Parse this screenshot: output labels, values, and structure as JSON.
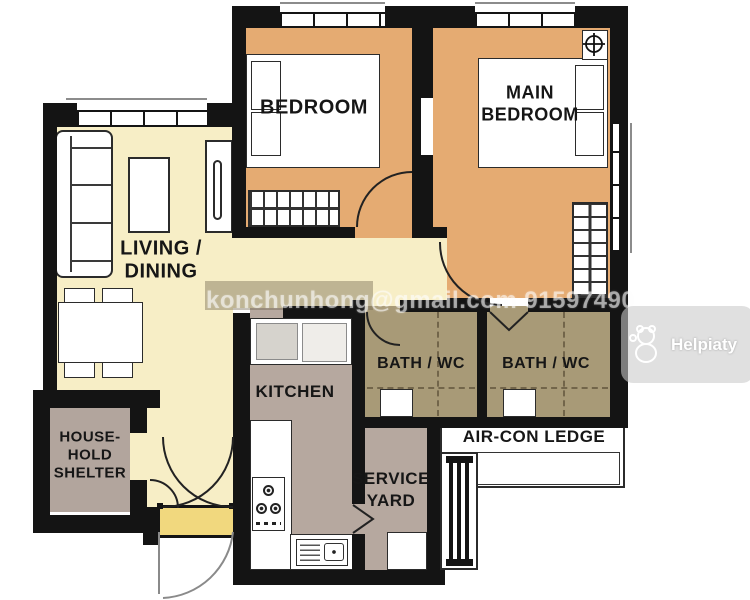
{
  "rooms": {
    "living_dining": {
      "line1": "LIVING /",
      "line2": "DINING"
    },
    "bedroom": {
      "label": "BEDROOM"
    },
    "main_bedroom": {
      "line1": "MAIN",
      "line2": "BEDROOM"
    },
    "kitchen": {
      "label": "KITCHEN"
    },
    "bath1": {
      "label": "BATH / WC"
    },
    "bath2": {
      "label": "BATH / WC"
    },
    "service_yard": {
      "line1": "SERVICE",
      "line2": "YARD"
    },
    "aircon_ledge": {
      "label": "AIR-CON LEDGE"
    },
    "household_shelter": {
      "line1": "HOUSE-",
      "line2": "HOLD",
      "line3": "SHELTER"
    }
  },
  "watermarks": {
    "contact": "konchunhong@gmail.com 91597490",
    "brand": "Helpiaty"
  },
  "colors": {
    "wall": "#141414",
    "living_floor": "#f7eec6",
    "bedroom_floor": "#e5ab72",
    "bath_floor": "#a89a77",
    "kitchen_floor": "#b6a89f",
    "shelter_floor": "#b2a59d",
    "threshold": "#f1d87e"
  }
}
